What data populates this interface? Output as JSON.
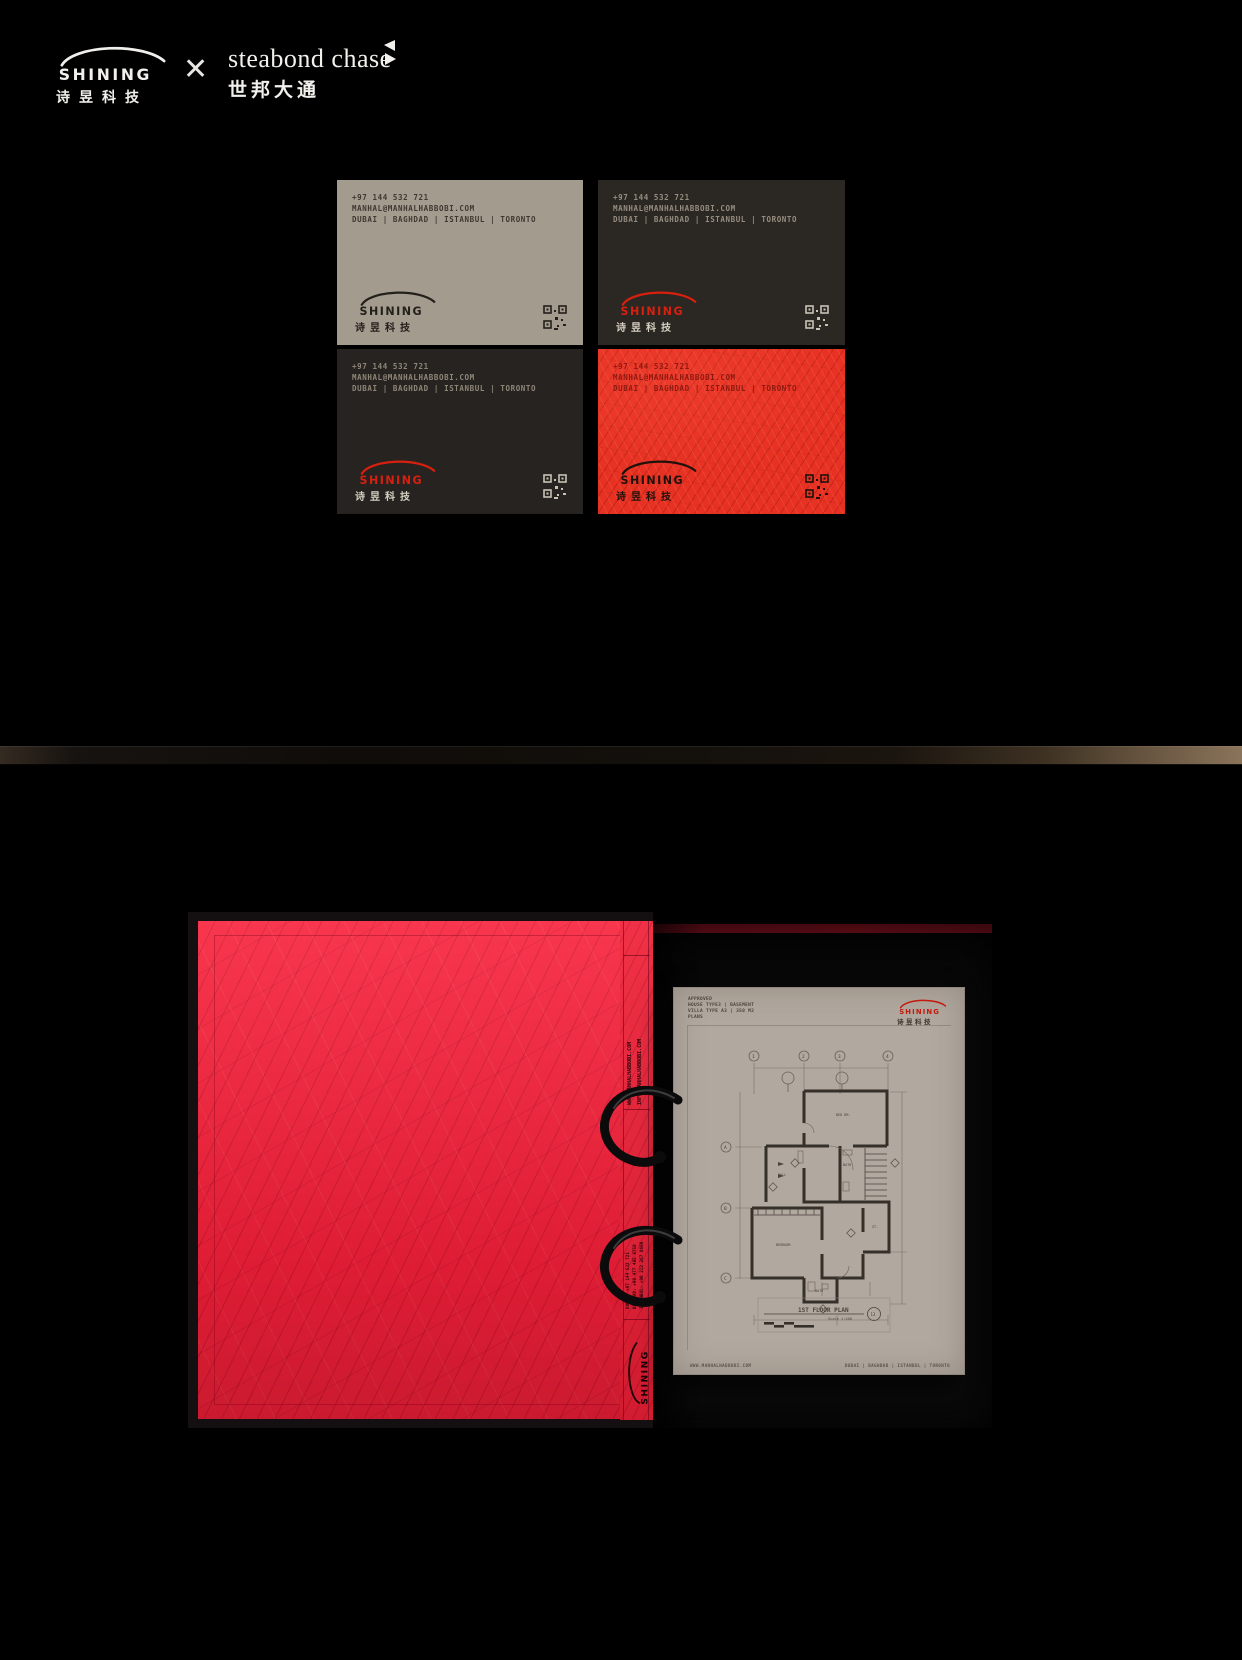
{
  "header": {
    "brand": {
      "logo_text": "SHINING",
      "logo_cn": "诗昱科技"
    },
    "cross": "✕",
    "partner": {
      "name": "steabond chase",
      "cn": "世邦大通"
    }
  },
  "business_cards": {
    "contact": {
      "phone": "+97 144 532 721",
      "email": "MANHAL@MANHALHABBOBI.COM",
      "cities": "DUBAI | BAGHDAD | ISTANBUL | TORONTO"
    },
    "logo_text": "SHINING",
    "logo_cn": "诗昱科技",
    "variants": [
      "warm-gray",
      "charcoal",
      "charcoal",
      "red-mesh"
    ]
  },
  "binder": {
    "spine": {
      "web": "WWW.MANHALHABBOBI.COM",
      "email": "INFO@MANHALHABBOBI.COM",
      "contact_lines": [
        "DUBAI: +97 144 532 721",
        "BAGHDAD: +96 477 485 8758",
        "ISTANBUL: +90 212 267 8698"
      ],
      "logo_text": "SHINING"
    },
    "document": {
      "header_lines": [
        "APPROVED",
        "HOUSE TYPE3 | BASEMENT",
        "VILLA TYPE A3 | 350 M2",
        "PLANS"
      ],
      "logo_text": "SHINING",
      "logo_cn": "诗昱科技",
      "plan": {
        "title": "1ST FLOOR PLAN",
        "scale": "Scale 1:100",
        "sheet": "13",
        "rooms": [
          "BED RM.",
          "HALL",
          "BATH",
          "BEDROOM",
          "BATH",
          "ST."
        ],
        "grid_cols": [
          "1",
          "2",
          "3",
          "4"
        ],
        "grid_rows": [
          "A",
          "B",
          "C"
        ]
      },
      "footer_left": "WWW.MANHALHABBOBI.COM",
      "footer_right": "DUBAI | BAGHDAD | ISTANBUL | TORONTO"
    }
  },
  "colors": {
    "background": "#000000",
    "brand_red": "#d7200f",
    "folder_red": "#f7203a",
    "card_gray": "#a49b8f",
    "card_charcoal": "#2a2623",
    "card_red": "#e73122",
    "paper": "#b1a89f"
  }
}
